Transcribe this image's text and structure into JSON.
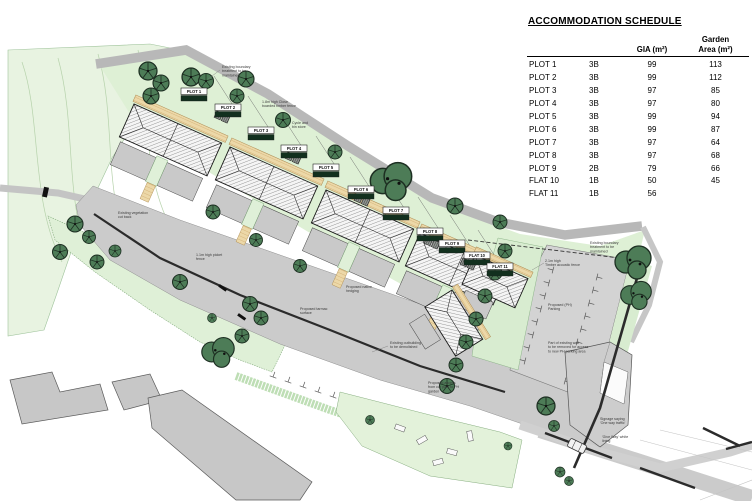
{
  "schedule": {
    "title": "ACCOMMODATION SCHEDULE",
    "columns": {
      "gia": "GIA (m²)",
      "garden_line1": "Garden",
      "garden_line2": "Area (m²)"
    },
    "rows": [
      {
        "plot": "PLOT 1",
        "type": "3B",
        "gia": "99",
        "garden": "113"
      },
      {
        "plot": "PLOT 2",
        "type": "3B",
        "gia": "99",
        "garden": "112"
      },
      {
        "plot": "PLOT 3",
        "type": "3B",
        "gia": "97",
        "garden": "85"
      },
      {
        "plot": "PLOT 4",
        "type": "3B",
        "gia": "97",
        "garden": "80"
      },
      {
        "plot": "PLOT 5",
        "type": "3B",
        "gia": "99",
        "garden": "94"
      },
      {
        "plot": "PLOT 6",
        "type": "3B",
        "gia": "99",
        "garden": "87"
      },
      {
        "plot": "PLOT 7",
        "type": "3B",
        "gia": "97",
        "garden": "64"
      },
      {
        "plot": "PLOT 8",
        "type": "3B",
        "gia": "97",
        "garden": "68"
      },
      {
        "plot": "PLOT 9",
        "type": "2B",
        "gia": "79",
        "garden": "66"
      },
      {
        "plot": "FLAT 10",
        "type": "1B",
        "gia": "50",
        "garden": "45"
      },
      {
        "plot": "FLAT 11",
        "type": "1B",
        "gia": "56",
        "garden": ""
      }
    ]
  },
  "plan": {
    "plot_markers": [
      {
        "label": "PLOT 1"
      },
      {
        "label": "PLOT 2"
      },
      {
        "label": "PLOT 3"
      },
      {
        "label": "PLOT 4"
      },
      {
        "label": "PLOT 5"
      },
      {
        "label": "PLOT 6"
      },
      {
        "label": "PLOT 7"
      },
      {
        "label": "PLOT 8"
      },
      {
        "label": "PLOT 9"
      },
      {
        "label": "FLAT 10"
      },
      {
        "label": "FLAT 11"
      }
    ],
    "annotations": [
      {
        "l1": "Existing boundary",
        "l2": "treatment to be",
        "l3": "maintained"
      },
      {
        "l1": "1.8m high Close",
        "l2": "boarded timber fence",
        "l3": ""
      },
      {
        "l1": "Cycle and",
        "l2": "bin store",
        "l3": ""
      },
      {
        "l1": "Existing boundary",
        "l2": "treatment to be",
        "l3": "maintained"
      },
      {
        "l1": "2.1m high",
        "l2": "Timber acoustic fence",
        "l3": ""
      },
      {
        "l1": "Proposed (PH)",
        "l2": "Parking",
        "l3": ""
      },
      {
        "l1": "Existing outbuilding",
        "l2": "to be demolished",
        "l3": ""
      },
      {
        "l1": "Part of existing wall",
        "l2": "to be removed for access",
        "l3": "to new PH parking area"
      },
      {
        "l1": "Proposed access",
        "l2": "from car park to PH",
        "l3": "garden"
      },
      {
        "l1": "Signage saying",
        "l2": "'One way traffic'",
        "l3": ""
      },
      {
        "l1": "'Give Way' white",
        "l2": "lining",
        "l3": ""
      },
      {
        "l1": "Existing vegetation",
        "l2": "cut back",
        "l3": ""
      },
      {
        "l1": "1.1m high picket",
        "l2": "fence",
        "l3": ""
      },
      {
        "l1": "Proposed tarmac",
        "l2": "surface",
        "l3": ""
      },
      {
        "l1": "Proposed native",
        "l2": "hedging",
        "l3": ""
      }
    ]
  },
  "colors": {
    "field_green": "#e8f3e1",
    "garden_green": "#def0d5",
    "hedge_green": "#bedeb5",
    "tree_green": "#4d7c57",
    "road_gray": "#cbcbcb",
    "parking_gray": "#d3d3d3",
    "path_tan": "#ecd8a8",
    "wall_dark": "#2b2b2b",
    "marker_badge": "#12301e"
  }
}
